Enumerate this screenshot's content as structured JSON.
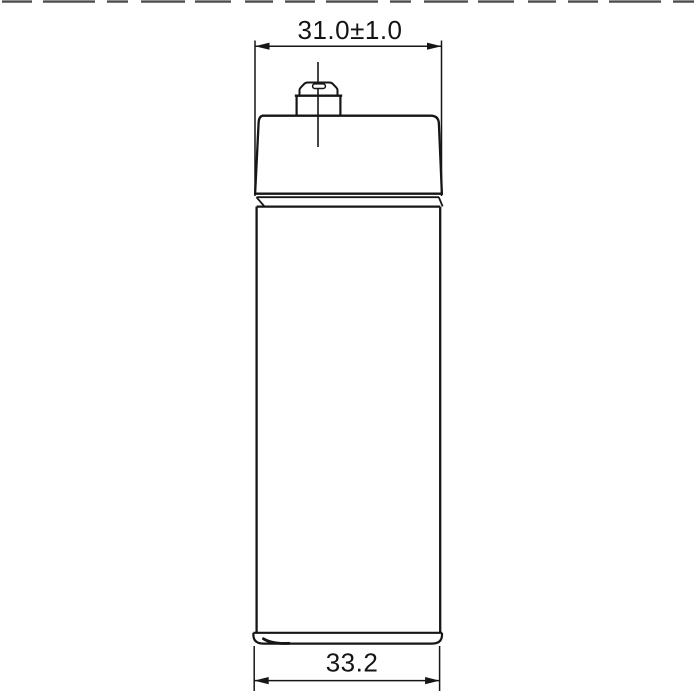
{
  "page": {
    "background": "#ffffff",
    "top_border_color": "#4d4d4d"
  },
  "drawing": {
    "line_color": "#161616",
    "dimensions": {
      "cap_width": {
        "value": "31.0±1.0"
      },
      "body_width": {
        "value": "33.2"
      }
    }
  }
}
